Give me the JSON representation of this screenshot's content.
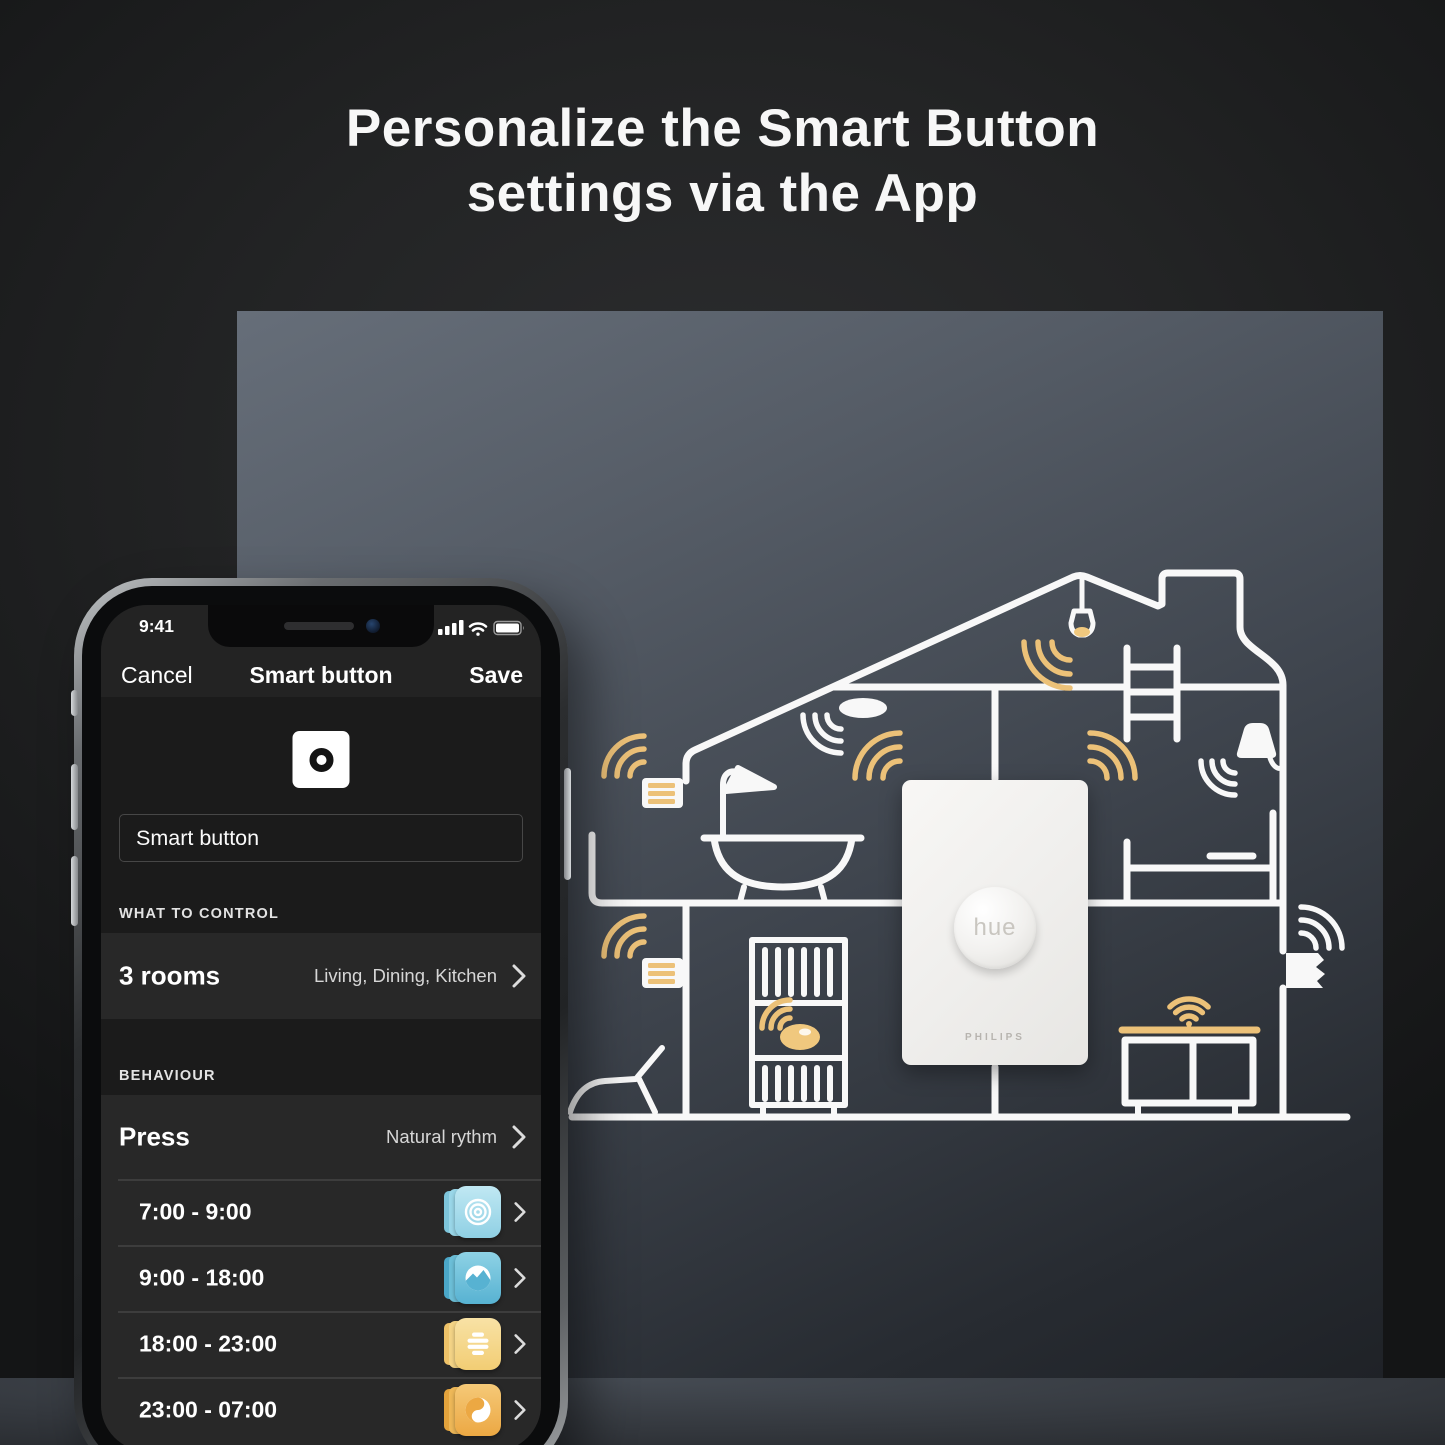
{
  "page": {
    "title": "Personalize the Smart Button settings via the App"
  },
  "phone": {
    "status_bar": {
      "time": "9:41",
      "icons": [
        "signal-bars-icon",
        "wifi-icon",
        "battery-icon"
      ]
    },
    "nav": {
      "cancel": "Cancel",
      "title": "Smart button",
      "save": "Save"
    },
    "name_field": {
      "value": "Smart button"
    },
    "sections": {
      "control": {
        "header": "WHAT TO CONTROL",
        "row": {
          "label": "3 rooms",
          "value": "Living, Dining, Kitchen"
        }
      },
      "behaviour": {
        "header": "BEHAVIOUR",
        "row": {
          "label": "Press",
          "value": "Natural rythm"
        }
      }
    },
    "schedule": [
      {
        "time": "7:00 - 9:00",
        "scene": "energize",
        "color": "#9bd4e7"
      },
      {
        "time": "9:00 - 18:00",
        "scene": "concentrate",
        "color": "#57b2d2"
      },
      {
        "time": "18:00 - 23:00",
        "scene": "read",
        "color": "#f2cd74"
      },
      {
        "time": "23:00 - 07:00",
        "scene": "nightlight",
        "color": "#eca843"
      }
    ]
  },
  "poster": {
    "device": {
      "button_label": "hue",
      "brand": "PHILIPS"
    }
  },
  "colors": {
    "accent_yellow": "#ecc178",
    "line_white": "#f8f8f8",
    "panel_top": "#666e79",
    "panel_bottom": "#1f2227"
  }
}
